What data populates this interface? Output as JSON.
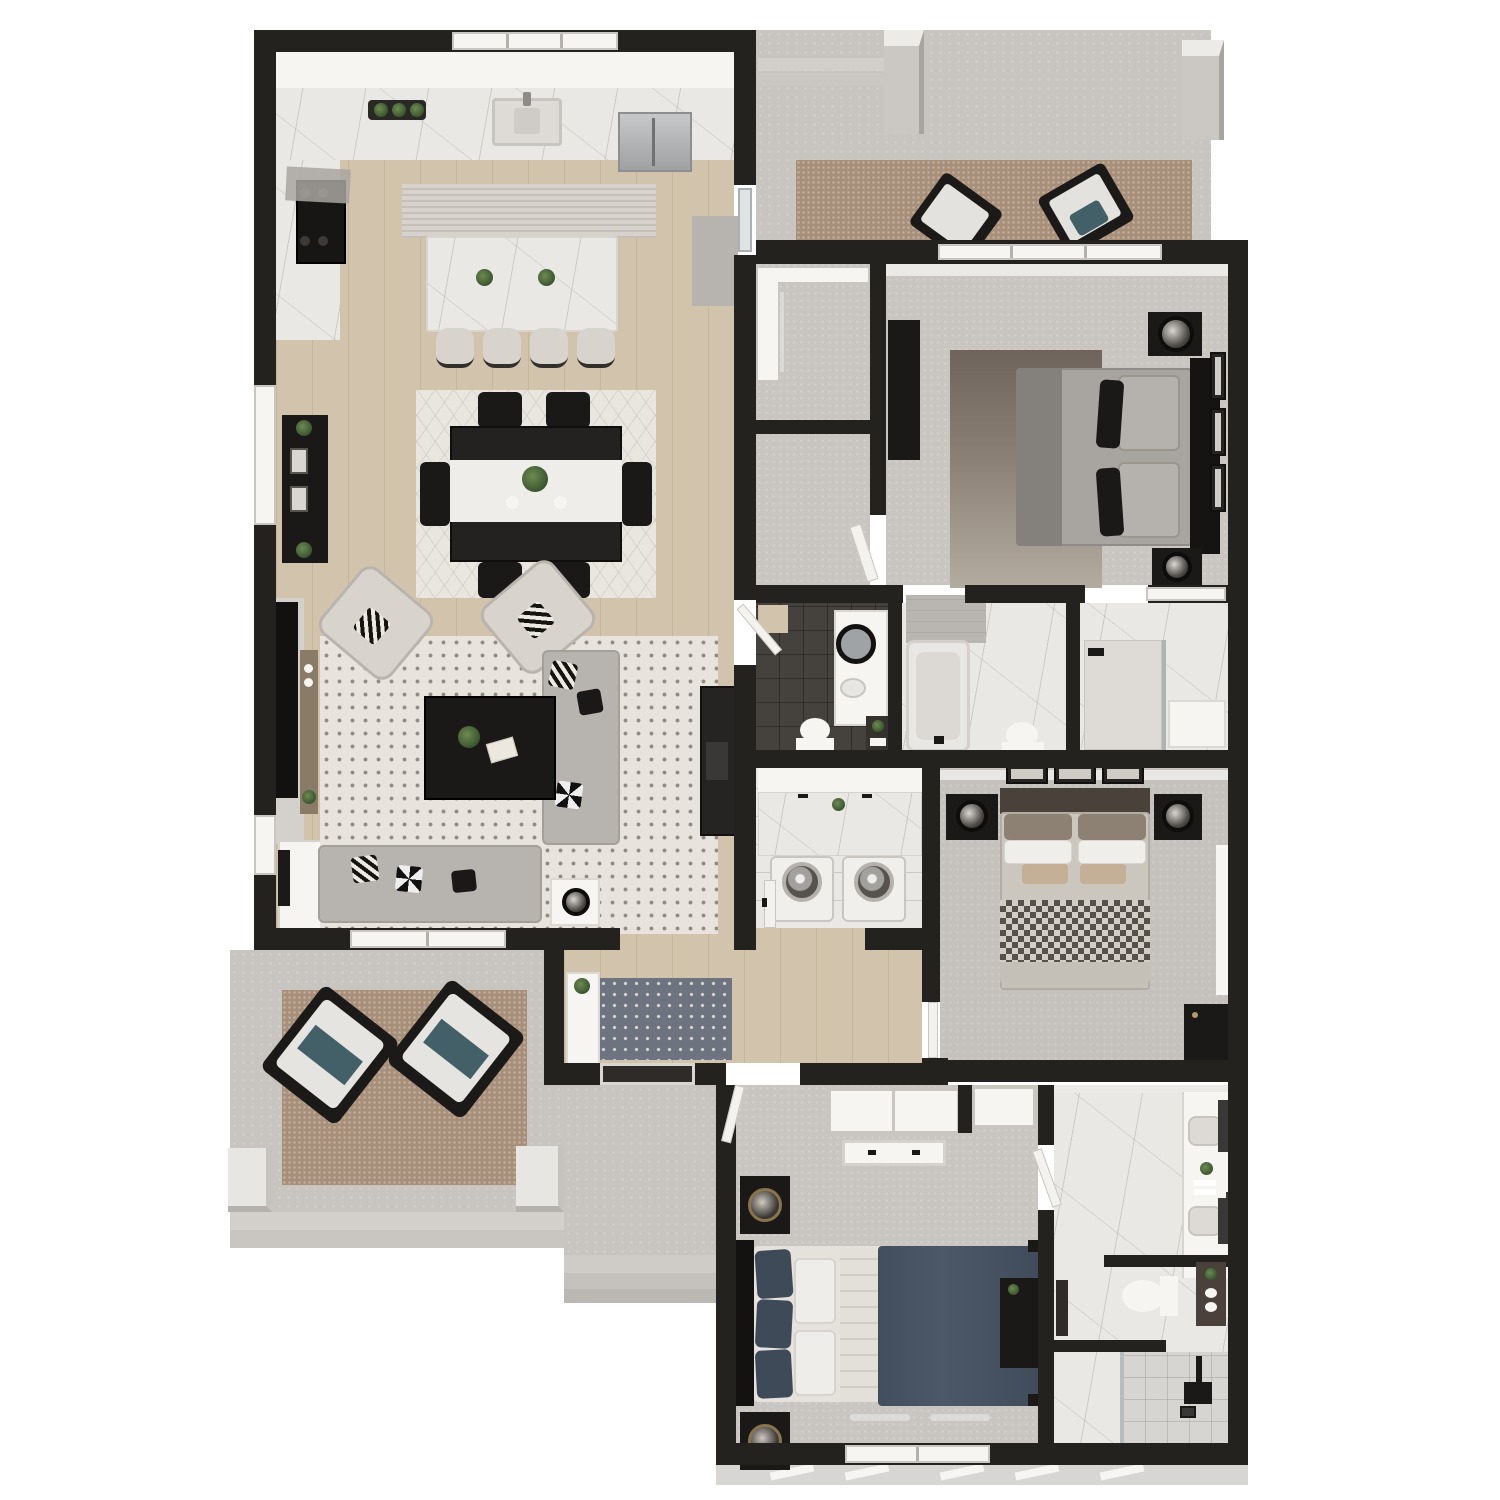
{
  "meta": {
    "description": "Photorealistic 3D dollhouse-style top-down rendering of a single-story 3-bedroom, 3.5-bath home floor plan with open great room, rear covered patio and front porch",
    "view": "isometric top-down architectural rendering",
    "visible_text": "none"
  },
  "palette": {
    "wall": "#24221f",
    "wood": "#d1c3ac",
    "carpet": "#c9c6c1",
    "carpet_master": "#c5c1bc",
    "concrete": "#c8c5c1",
    "concrete_light": "#d3d0cc",
    "marble": "#eae8e5",
    "tile_dark": "#45423e",
    "tile_white": "#e9e8e5",
    "black": "#1b1918",
    "white": "#f6f5f2",
    "offwhite": "#efedea",
    "sofa": "#b7b3ae",
    "cream": "#d8d4cd",
    "rug_living": "#e8e4dd",
    "rug_brown": "#a78f79",
    "rug_dining": "#e9e6e0",
    "rug_runner": "#d7d3cc",
    "rug_entry": "#6d7480",
    "bed_navy": "#4c5868",
    "bed_gray": "#a8a49f",
    "bed_greige": "#cbc6be",
    "stainless": "#b4b6b8",
    "wood_brown": "#8a7b68",
    "green": "#4f6b3f",
    "teal": "#435f68",
    "tan": "#c3b096",
    "siding": "#d8d6d3"
  },
  "rooms": {
    "great_room": "Open-concept great room: kitchen, dining and living areas with light oak flooring",
    "kitchen": "Kitchen with quartz counters, range, farmhouse sink and island seating",
    "dining_area": "Dining area with black 6-seat table on geometric rug",
    "living_area": "Living area with sectional, accent chairs and coffee table on dotted rug",
    "rear_patio": "Rear covered patio with outdoor rug, two lounge chairs and columns",
    "bedroom_2": "Bedroom 2 with gray upholstered bed and ombre rug",
    "closet_2": "Walk-in closet serving bedroom 2",
    "powder_bath": "Powder bathroom with dark tile floor, round mirror vanity and toilet",
    "hall_bath": "Hall bathroom with soaking tub, toilet and marble floor",
    "shower_room": "Marble walk-in shower room with window and bench",
    "laundry_room": "Laundry room with quartz folding counter over washer and dryer",
    "master_bedroom": "Primary bedroom with upholstered bed, checkered throw and twin nightstands",
    "entry_hall": "Entry foyer with console table and patterned runner",
    "front_porch": "Front porch with two lounge chairs on outdoor rug and columns",
    "walkway": "Front entry walkway with concrete steps",
    "bedroom_3": "Bedroom 3 with navy bed, double closets and dresser",
    "bath_3": "En-suite bathroom with double vanity, water closet and walk-in shower"
  },
  "furniture": {
    "kitchen_window": "Triple window above kitchen sink",
    "kitchen_sink": "Farmhouse sink with faucet",
    "range": "Range with hood on left wall",
    "fridge": "Stainless steel refrigerator",
    "herb_tray": "Tray of potted herbs on counter",
    "island": "Quartz waterfall island with two plants",
    "stools": "Four cream counter stools",
    "kitchen_runner": "Woven runner rug behind island",
    "patio_door_mat": "Gray door mat at patio slider",
    "dining_rug": "Light geometric area rug",
    "dining_table": "Black rectangular dining table with white runner and centerpiece plant",
    "dining_chairs": "Six black dining chairs",
    "media_console": "Black media console with plants and framed art",
    "tv_wall": "Wall-mounted TV over gray fireplace surround with wood mantel shelf",
    "accent_chairs": "Two cream swivel accent chairs with patterned pillows",
    "coffee_table": "Black square coffee table with plant and magazine",
    "sectional": "Gray L-shaped sectional sofa with accent pillows",
    "side_table": "White side table with black sphere lamp",
    "fireplace_unit": "Dark fireplace / media cabinet on right wall",
    "white_cabinet": "White storage cabinet with leaning art frame",
    "patio_rug": "Brown woven outdoor rug",
    "patio_chairs": "Two black-frame lounge chairs with white and teal cushions",
    "patio_columns": "Square porch columns",
    "bed2": "Gray queen bed with black headboard and accent pillows",
    "bed2_rug": "Brown-to-tan ombre rug",
    "bed2_nightstands": "Black nightstands with drum-shade lamps",
    "bed2_dresser": "Tall black dresser",
    "bed2_frames": "Three framed prints on wall",
    "closet_shelving": "White closet shelving tower and rod",
    "powder_vanity": "White vanity with round black mirror and vessel sink",
    "powder_toilet": "Toilet",
    "ladder_shelf": "Dark ladder shelf with plant and towels",
    "tub": "Alcove soaking tub with tiled surround",
    "hall_toilet": "Toilet",
    "shower_bench": "Built-in white bench",
    "laundry_counter": "Quartz counter with plant over appliances",
    "washer_dryer": "Front-load washer and dryer pair",
    "master_bed": "Greige upholstered bed with brown, white and tan pillows and checkered throw",
    "master_nightstands": "Black nightstands with metallic sphere lamps",
    "master_frames": "Three framed prints above headboard",
    "master_dresser": "Black dresser with brass hardware",
    "entry_console": "White console table with potted plant",
    "entry_rug": "Navy patterned runner rug",
    "front_door": "Front entry door",
    "bed3": "Navy platform bed with white pillows and black corner posts",
    "bed3_nightstands": "Black nightstands with gold-ring lamps",
    "bed3_dresser": "Black dresser with decor",
    "bed3_closets": "Double closets with white sliding doors",
    "vanity_double": "Double-sink vanity with two mirrors and towel niche",
    "wc_toilet": "Toilet with ladder shelf",
    "shower_fixture": "Matte black rain shower fixture and drain"
  }
}
